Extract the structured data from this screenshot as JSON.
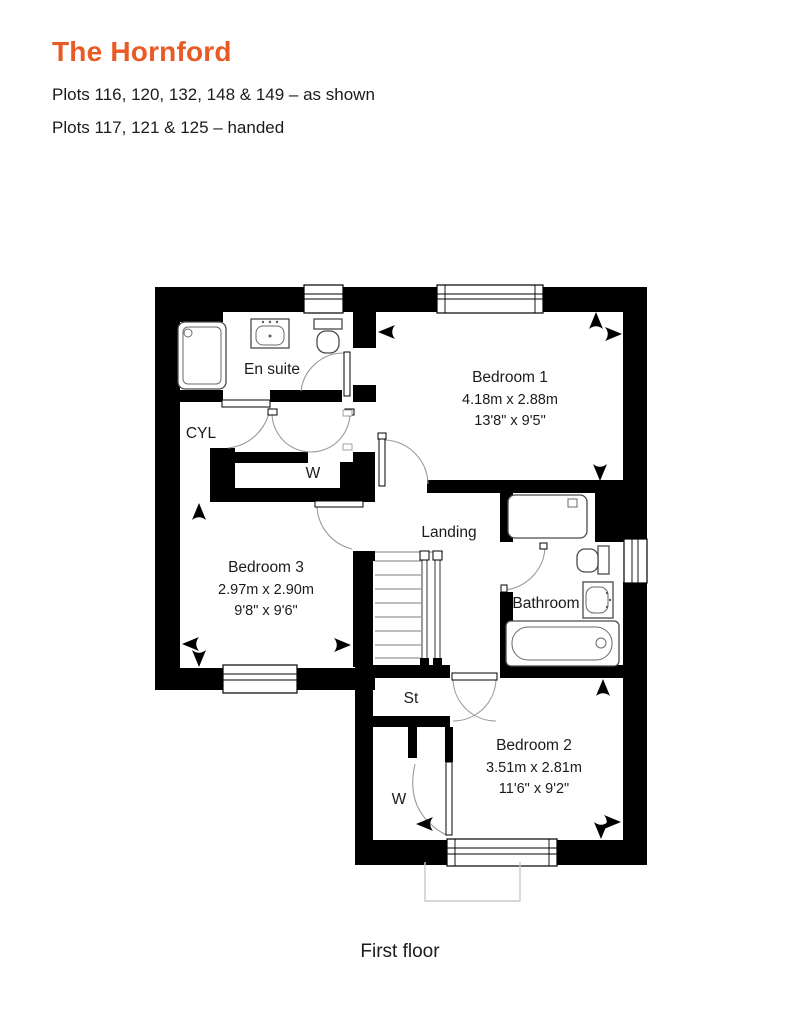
{
  "header": {
    "title": "The Hornford",
    "line1": "Plots 116, 120, 132, 148 & 149 – as shown",
    "line2": "Plots 117, 121 & 125 – handed"
  },
  "floor_label": "First floor",
  "colors": {
    "accent_orange": "#E95B26",
    "text": "#1B1B1B",
    "wall": "#000000",
    "fixture_line": "#4A4A4A",
    "door_arc": "#9A9A9A",
    "porch_outline": "#C9C9C9"
  },
  "rooms": [
    {
      "id": "ensuite",
      "label": "En suite"
    },
    {
      "id": "cylinder",
      "label": "CYL"
    },
    {
      "id": "wardrobe1",
      "label": "W"
    },
    {
      "id": "bedroom1",
      "label": "Bedroom 1",
      "dim_metric": "4.18m x 2.88m",
      "dim_imperial": "13'8\" x 9'5\""
    },
    {
      "id": "landing",
      "label": "Landing"
    },
    {
      "id": "bedroom3",
      "label": "Bedroom 3",
      "dim_metric": "2.97m x 2.90m",
      "dim_imperial": "9'8\" x 9'6\""
    },
    {
      "id": "bathroom",
      "label": "Bathroom"
    },
    {
      "id": "store",
      "label": "St"
    },
    {
      "id": "wardrobe2",
      "label": "W"
    },
    {
      "id": "bedroom2",
      "label": "Bedroom 2",
      "dim_metric": "3.51m x 2.81m",
      "dim_imperial": "11'6\" x 9'2\""
    }
  ]
}
